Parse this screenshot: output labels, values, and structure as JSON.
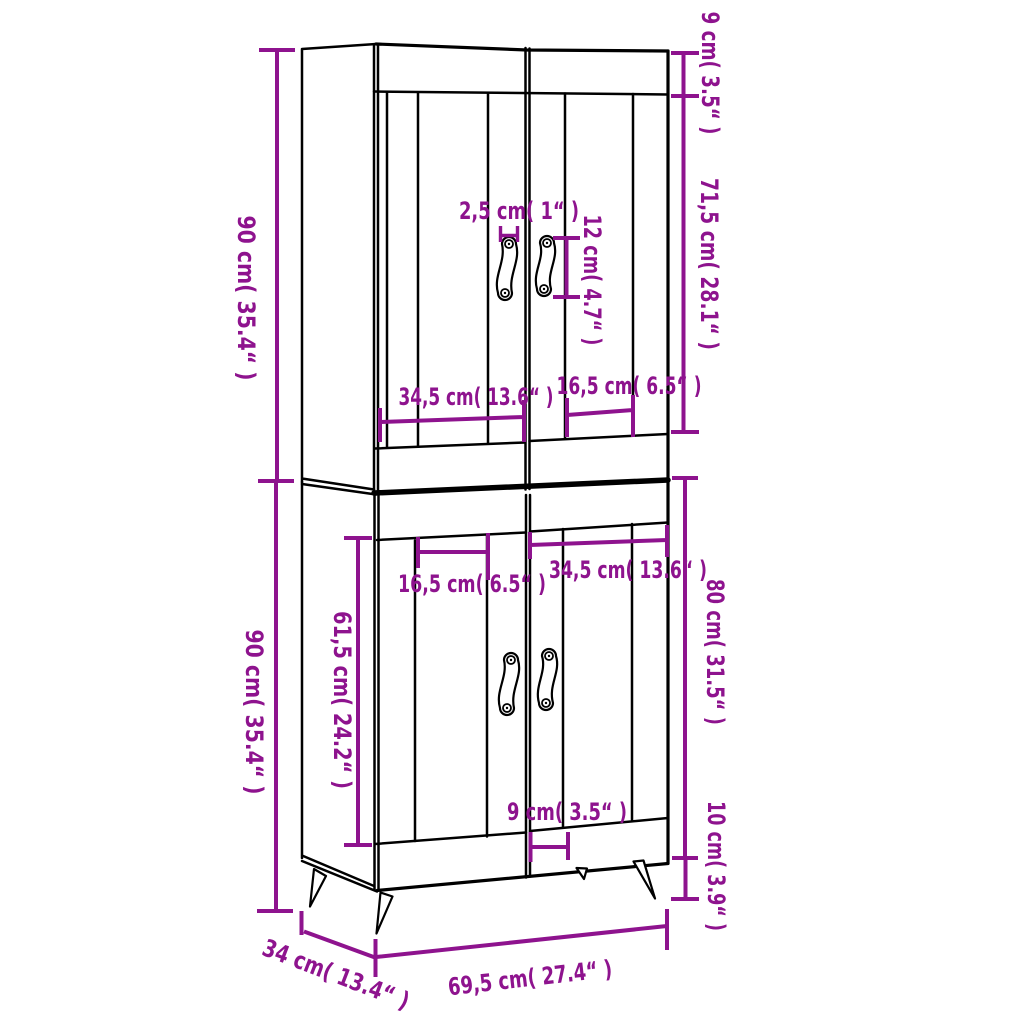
{
  "diagram": {
    "subject": "highboard-cabinet-dimension-diagram",
    "background": "#ffffff",
    "line_color": "#000000",
    "accent_color": "#8e138e"
  },
  "labels": {
    "upper_height_left": "90 cm( 35.4“ )",
    "lower_height_left": "90 cm( 35.4“ )",
    "top_rail_height": "9 cm( 3.5“ )",
    "upper_door_height": "71,5 cm( 28.1“ )",
    "handle_inset": "2,5 cm( 1“ )",
    "handle_length": "12 cm( 4.7“ )",
    "upper_left_door_width": "34,5 cm( 13.6“ )",
    "upper_right_door_width": "16,5 cm( 6.5“ )",
    "lower_left_door_width": "16,5 cm( 6.5“ )",
    "lower_right_door_width": "34,5 cm( 13.6“ )",
    "lower_door_height": "61,5 cm( 24.2“ )",
    "lower_unit_height": "80 cm( 31.5“ )",
    "leg_height": "10 cm( 3.9“ )",
    "bottom_center_width": "9 cm( 3.5“ )",
    "depth": "34 cm( 13.4“ )",
    "total_width": "69,5 cm( 27.4“ )"
  }
}
